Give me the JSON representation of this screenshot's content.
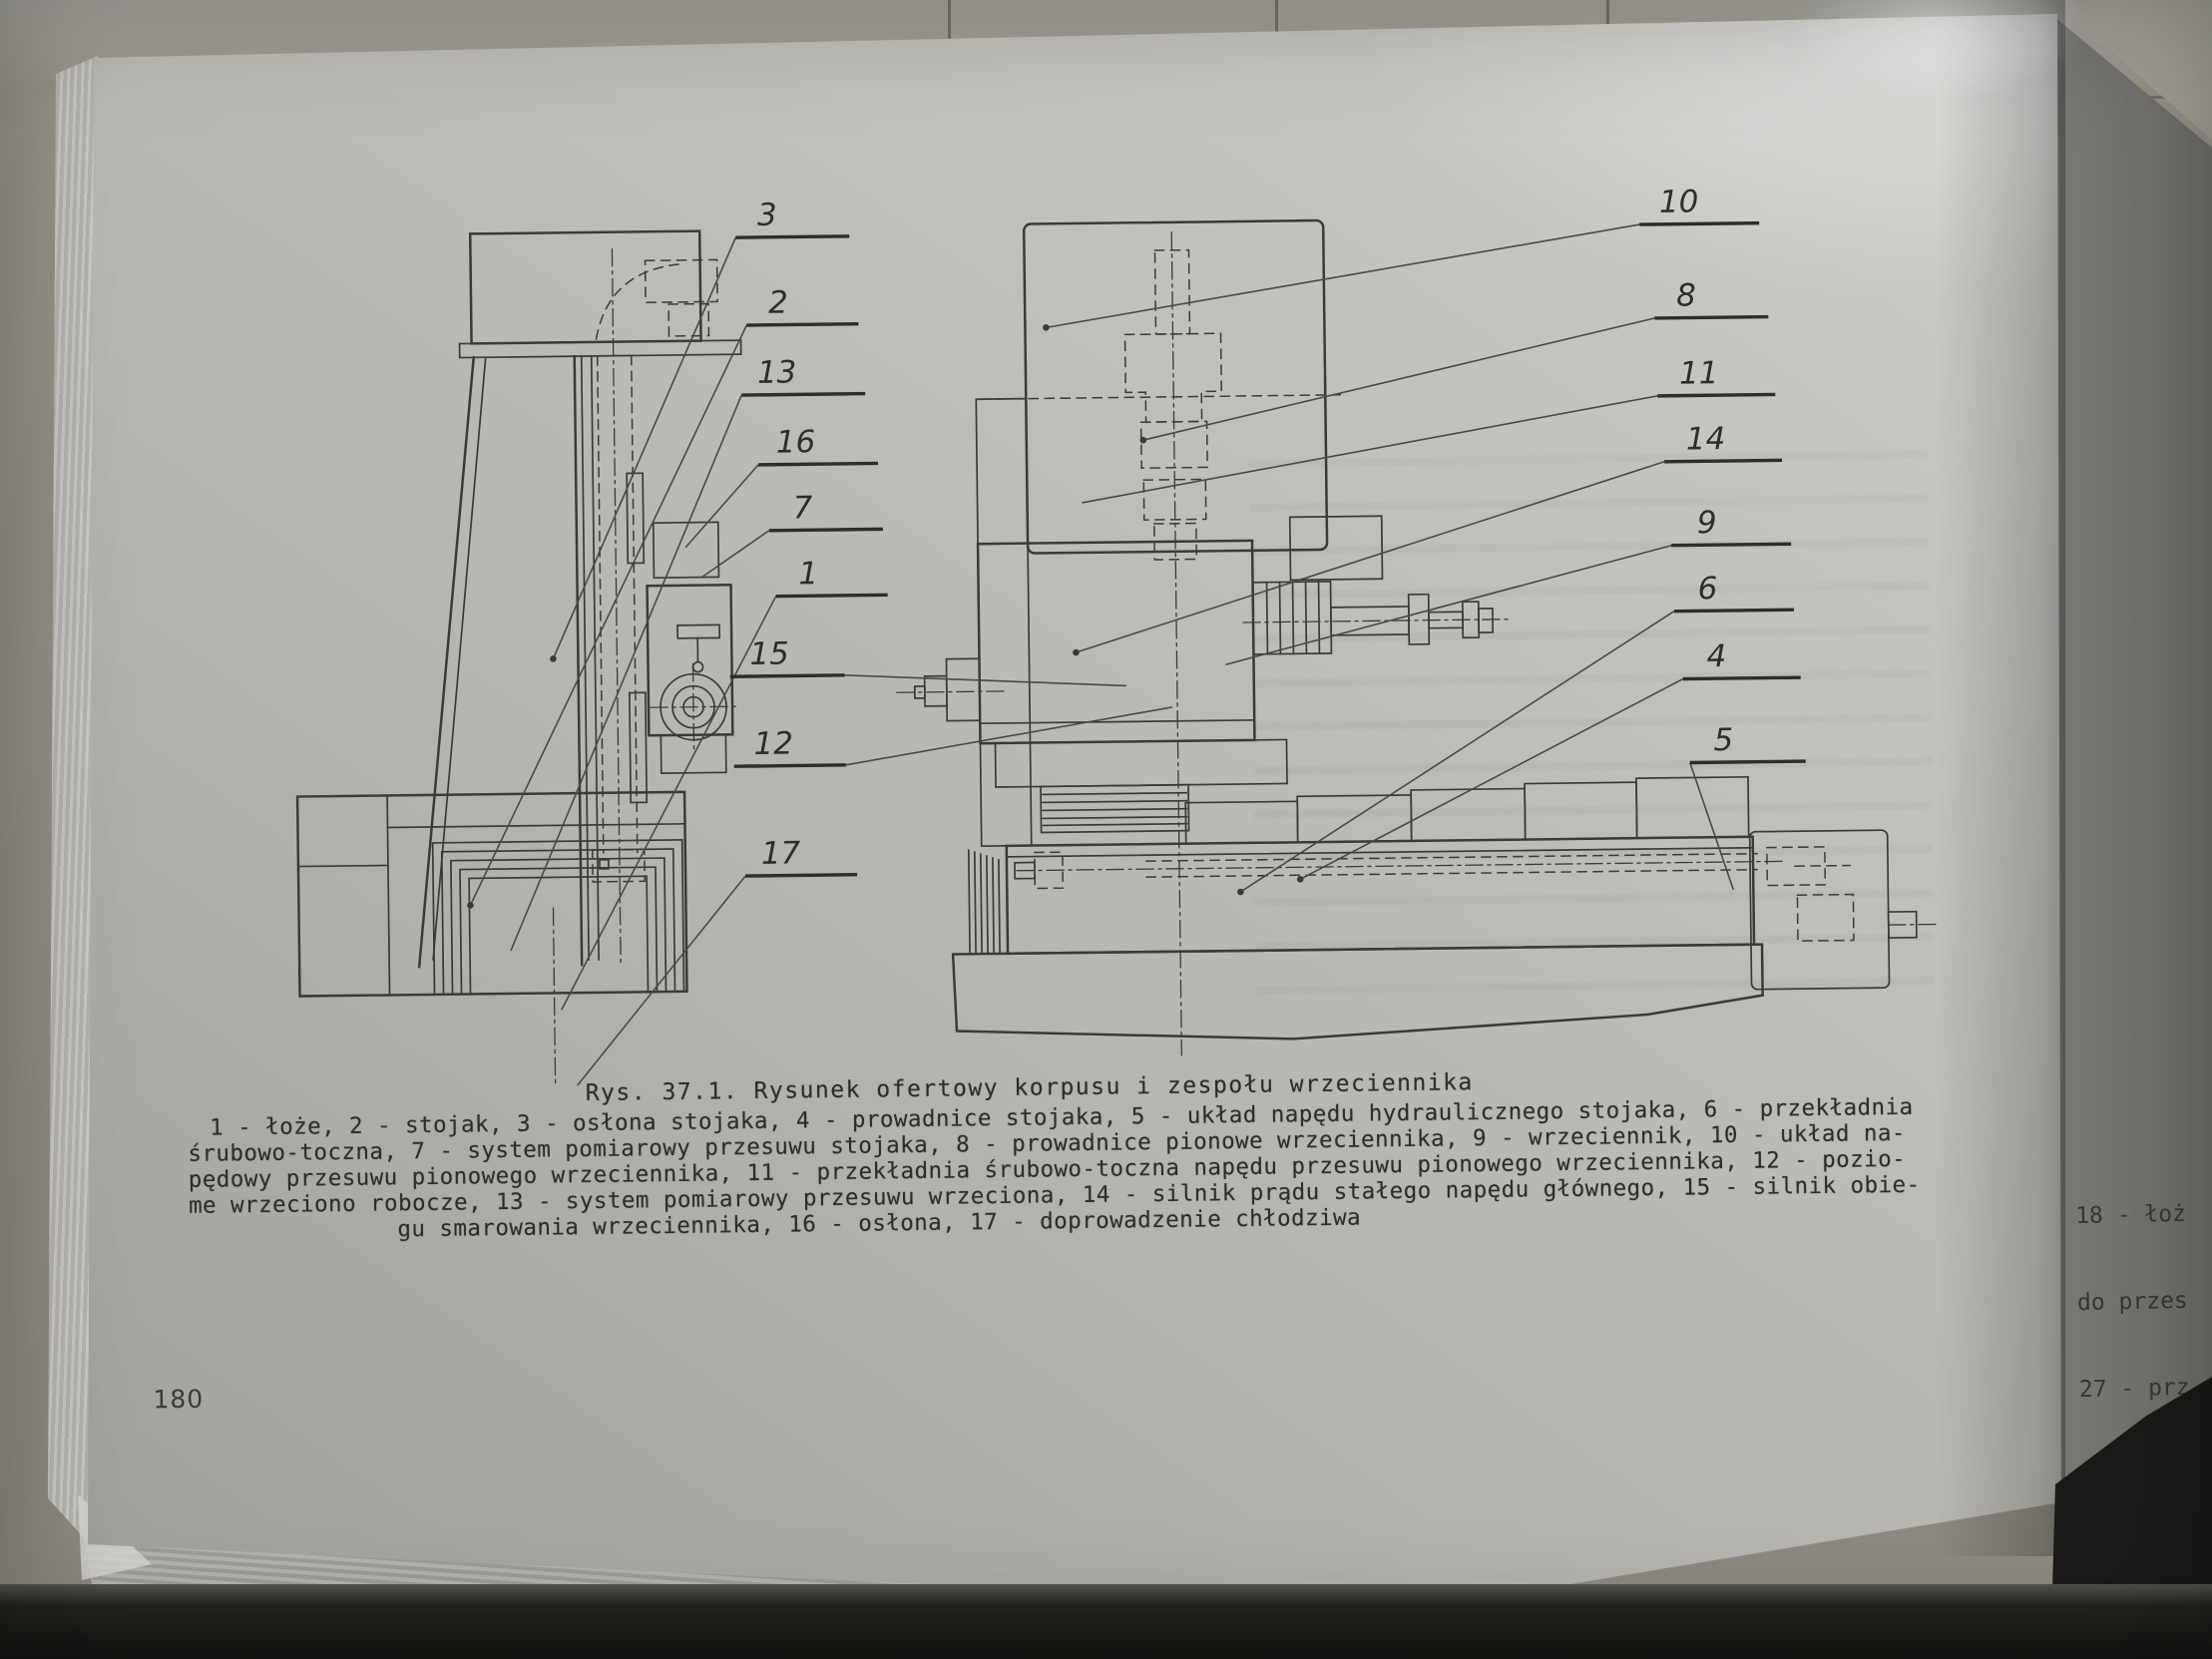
{
  "book_page": {
    "page_number": "180",
    "caption": "Rys. 37.1. Rysunek ofertowy korpusu i zespołu wrzeciennika",
    "legend_lines": [
      "1 - łoże, 2 - stojak, 3 - osłona stojaka, 4 - prowadnice stojaka, 5 - układ napędu hydraulicznego stojaka, 6 - przekładnia",
      "śrubowo-toczna, 7 - system pomiarowy przesuwu stojaka, 8 - prowadnice pionowe wrzeciennika, 9 - wrzeciennik, 10 - układ na-",
      "pędowy przesuwu pionowego wrzeciennika, 11 - przekładnia śrubowo-toczna napędu przesuwu pionowego wrzeciennika, 12 - pozio-",
      "me wrzeciono robocze, 13 - system pomiarowy przesuwu wrzeciona, 14 - silnik prądu stałego napędu głównego, 15 - silnik obie-",
      "gu smarowania wrzeciennika, 16 - osłona, 17 - doprowadzenie chłodziwa"
    ]
  },
  "next_page": {
    "fragment_lines": [
      "18 - łoż",
      "do przes",
      "27 - prz"
    ]
  },
  "diagram": {
    "labels": [
      {
        "text": "3"
      },
      {
        "text": "2"
      },
      {
        "text": "13"
      },
      {
        "text": "16"
      },
      {
        "text": "7"
      },
      {
        "text": "1"
      },
      {
        "text": "15"
      },
      {
        "text": "12"
      },
      {
        "text": "17"
      },
      {
        "text": "10"
      },
      {
        "text": "8"
      },
      {
        "text": "11"
      },
      {
        "text": "14"
      },
      {
        "text": "9"
      },
      {
        "text": "6"
      },
      {
        "text": "4"
      },
      {
        "text": "5"
      }
    ]
  },
  "colors": {
    "paper": "#bcbbb8",
    "ink": "#3b3a36",
    "desk_wood": "#96948b",
    "shadow": "#1b1a18"
  }
}
